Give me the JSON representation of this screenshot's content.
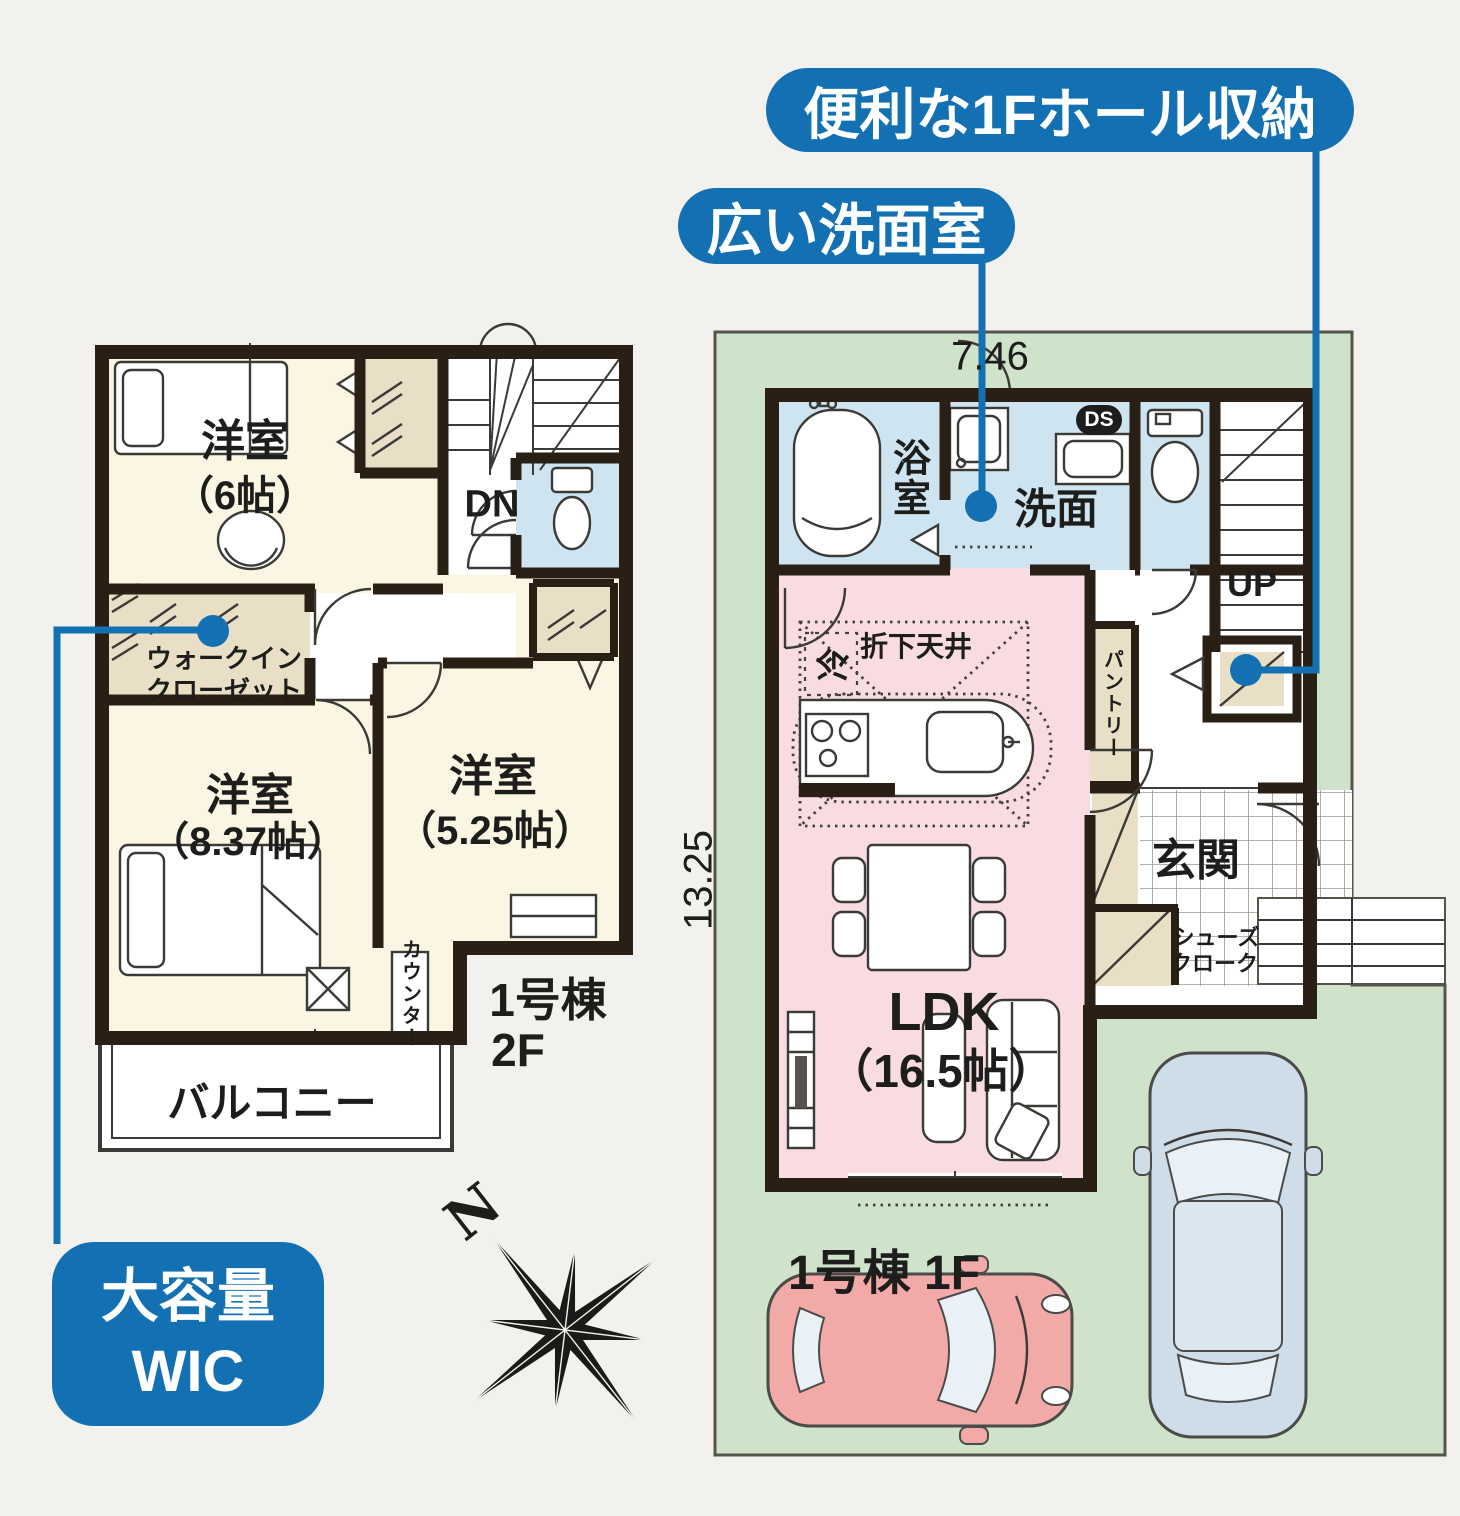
{
  "page": {
    "background": "#f2f1ee"
  },
  "colors": {
    "accent_blue": "#1371b3",
    "wall": "#2a1f15",
    "room_cream": "#faf6e3",
    "closet_beige": "#e8dfc6",
    "wet_blue": "#cfe4f1",
    "ldk_pink": "#f8dce2",
    "site_green": "#cfe3ca",
    "car_pink": "#f2aaa8",
    "car_blue": "#cfdde9"
  },
  "callouts": {
    "hall_storage": "便利な1Fホール収納",
    "washroom": "広い洗面室",
    "wic_line1": "大容量",
    "wic_line2": "WIC"
  },
  "site": {
    "width": "7.46",
    "depth": "13.25"
  },
  "compass": {
    "north": "N"
  },
  "floor2": {
    "title_line1": "1号棟",
    "title_line2": "2F",
    "bedroom_a": "洋室",
    "bedroom_a_size": "（6帖）",
    "bedroom_b": "洋室",
    "bedroom_b_size": "（8.37帖）",
    "bedroom_c": "洋室",
    "bedroom_c_size": "（5.25帖）",
    "wic_line1": "ウォークイン",
    "wic_line2": "クローゼット",
    "counter": "カウンター",
    "balcony": "バルコニー",
    "down": "DN"
  },
  "floor1": {
    "title": "1号棟 1F",
    "bath": "浴室",
    "wash": "洗面",
    "duct": "DS",
    "up": "UP",
    "fridge": "冷",
    "ceiling": "折下天井",
    "pantry": "パントリー",
    "ldk": "LDK",
    "ldk_size": "（16.5帖）",
    "entrance": "玄関",
    "shoes_line1": "シューズ",
    "shoes_line2": "クローク"
  }
}
